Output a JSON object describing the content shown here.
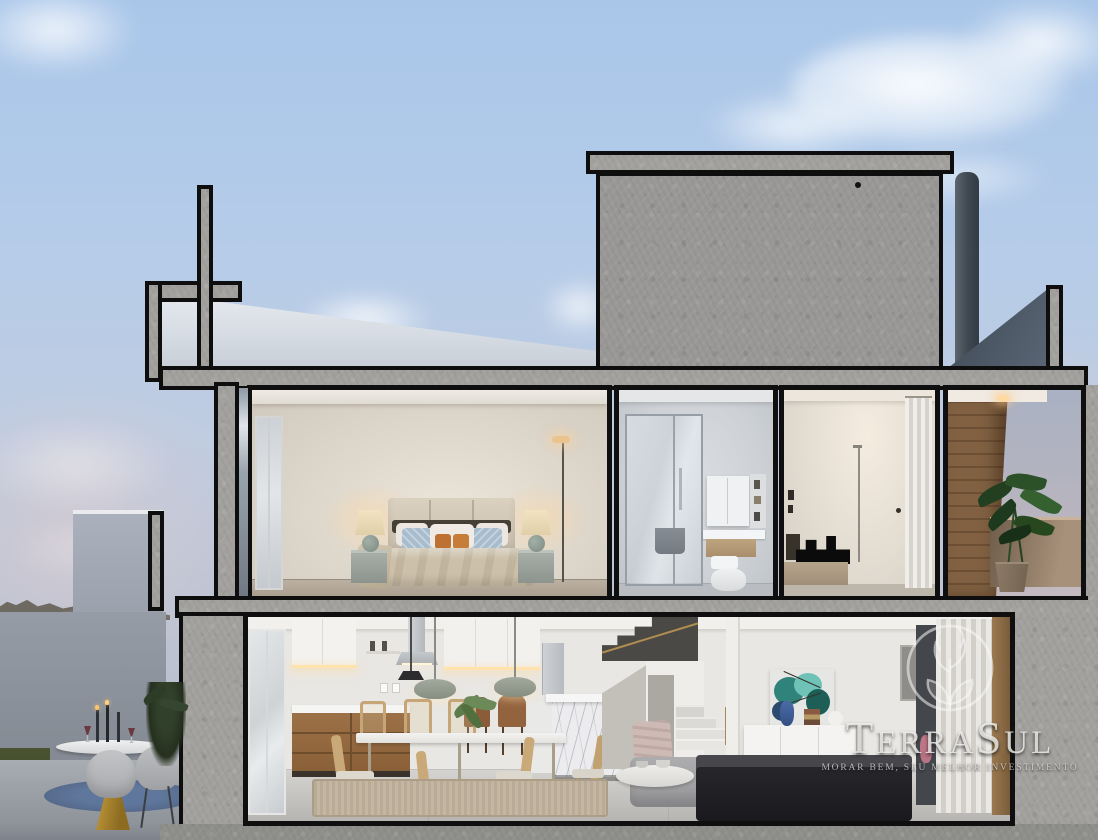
{
  "watermark": {
    "logo_icon": "tree-in-circle-icon",
    "brand_full": "TerraSul",
    "brand_part1": "T",
    "brand_part2": "ERRA",
    "brand_part3": "S",
    "brand_part4": "UL",
    "tagline": "MORAR BEM, SEU MELHOR INVESTIMENTO"
  },
  "palette": {
    "sky_top": "#aac7e9",
    "sky_horizon": "#b9bfce",
    "concrete_cut": "#a2a19e",
    "section_outline": "#0e0e0e",
    "upper_box_concrete": "#989795",
    "chimney_gray": "#49525e",
    "terrace_wood": "#7c5c3e",
    "kitchen_wood": "#96693f",
    "bedroom_wall": "#d9d3c8",
    "sofa_dark": "#1f1f23",
    "painting_teal": "#2f837b",
    "gold_accent": "#a5822e",
    "plant_green": "#2a4f26",
    "watermark_silver": "rgba(242,240,237,0.82)"
  }
}
